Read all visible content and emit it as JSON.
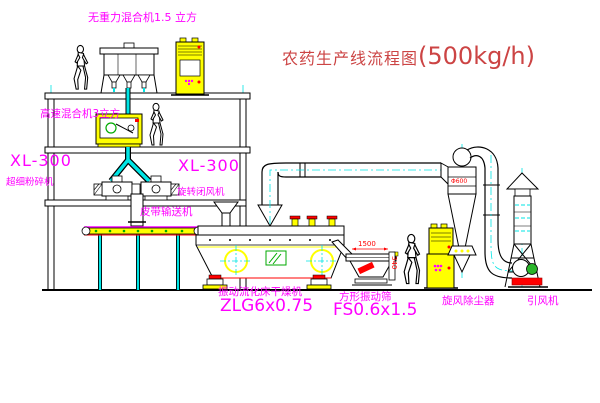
{
  "title": {
    "name_cn": "农药生产线流程图",
    "capacity": "(500kg/h)",
    "color": "#cc4444"
  },
  "labels": {
    "gravity_mixer": "无重力混合机1.5 立方",
    "high_speed_mixer": "高速混合机3立方",
    "crusher_model_left": "XL-300",
    "crusher_name_left": "超细粉碎机",
    "crusher_model_mid": "XL-300",
    "rotary_valve_name": "旋转闭风机",
    "belt_conveyor": "皮带输送机",
    "dryer_name": "振动流化床干燥机",
    "dryer_model": "ZLG6x0.75",
    "sieve_name": "方形振动筛",
    "sieve_model": "FS0.6x1.5",
    "cyclone_name": "旋风除尘器",
    "fan_name": "引风机"
  },
  "dimensions": {
    "sieve_length": "1500",
    "sieve_height": "340",
    "cyclone_dia": "Φ600"
  },
  "colors": {
    "label_magenta": "#ff00ff",
    "line_black": "#000000",
    "centerline_cyan": "#00e5e5",
    "equipment_yellow": "#ffff00",
    "detail_green": "#00aa00",
    "dimension_red": "#ff0000",
    "title_red": "#cc4444"
  }
}
